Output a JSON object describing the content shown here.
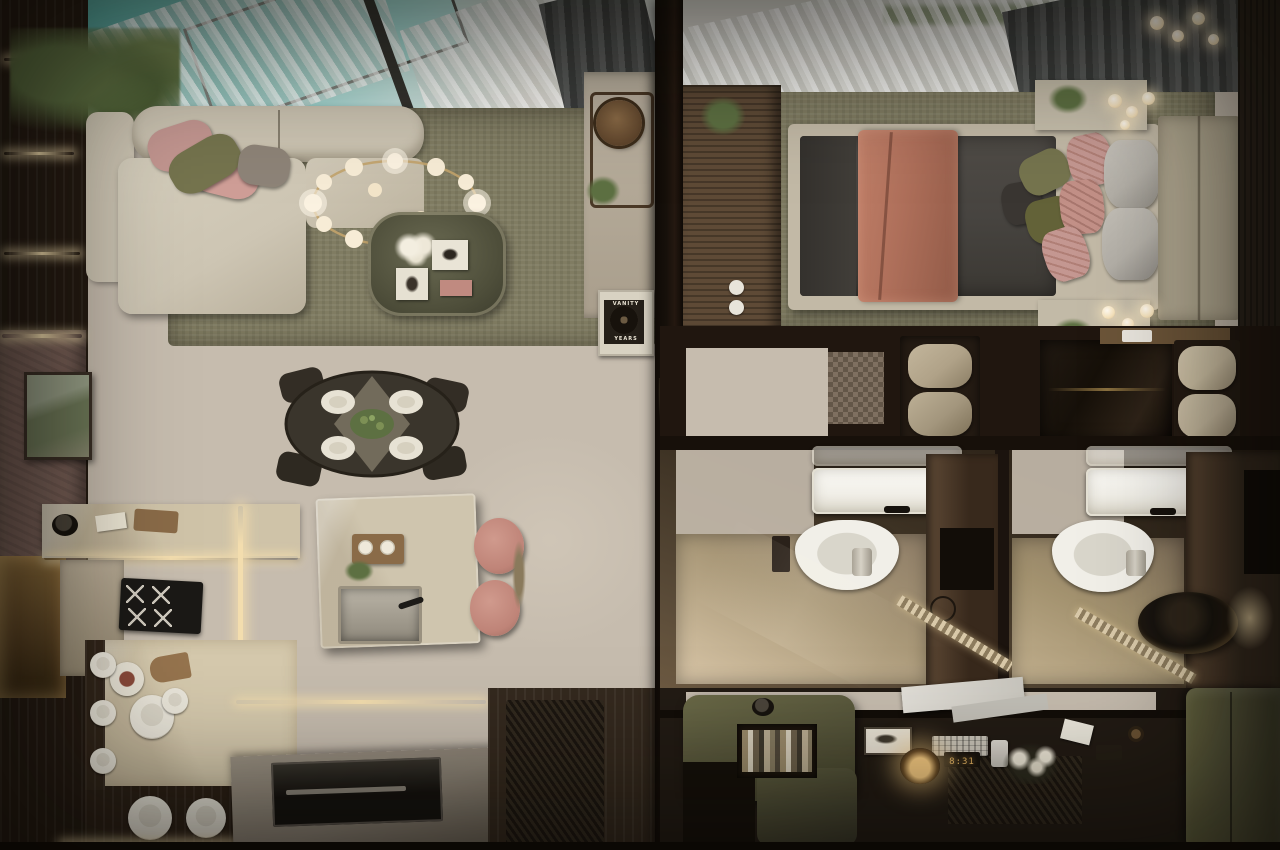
{
  "scene": {
    "view": "top-down interior render",
    "left_unit": "living room, dining, kitchen with island and pool-facing skylight window",
    "right_unit": "bedroom, entry benches, two bathrooms, home office with desk and olive sofas"
  },
  "texts": {
    "poster_line1": "VANITY",
    "poster_line2": "YEARS",
    "clock_display": "8:31"
  },
  "palette": {
    "wood-dark": "#241a12",
    "wood-console": "#5e4a36",
    "divider": "#16100a",
    "floor-terrazzo": "#c6bcae",
    "floor-speckle": "#92postfix",
    "floor-speckle2": "#928474",
    "rug-olive": "#807c62",
    "sofa-beige": "#cdc5b3",
    "pillow-pink": "#c49791",
    "pillow-olive": "#75744e",
    "pool-teal": "#8ecfc8",
    "pool-teal-deep": "#56aca4",
    "curtain-sheer": "#e8e7e3",
    "curtain-dark": "#4e504f",
    "brass": "#c2a36b",
    "glow-warm": "#f6e3bd",
    "led-glow": "#f3ddae",
    "table-dark": "#3a352c",
    "plate-white": "#eae6da",
    "island-marble": "#cfc5ae",
    "stool-pink": "#bf8478",
    "hob-black": "#1b1916",
    "cabinet-taupe": "#8d8477",
    "bed-duvet": "#474440",
    "bed-throw": "#ae6f5a",
    "bed-frame": "#c2b9a6",
    "headboard": "#afa68f",
    "pillow-gray": "#b2aea6",
    "wall-mauve": "#7b625a",
    "art-green": "#6f7a5a",
    "sink-white": "#f1efe8",
    "vanity-dark": "#38291c",
    "bench-leather": "#b0a288",
    "marble-black": "#161009",
    "office-floor": "#221b14",
    "desk-wood": "#a89a80",
    "sofa-olive": "#56553a",
    "lamp-glow": "#f3c880",
    "mat-dark": "#2b241b",
    "clock-glow": "#e8b765",
    "plant-green": "#5d7042"
  },
  "inventory": {
    "living": [
      "l-shaped-sofa",
      "ring-chandelier",
      "glass-coffee-table",
      "round-dining-table",
      "kitchen-island",
      "pink-stools",
      "gas-hob",
      "plate-shelves",
      "framed-artwork",
      "vanity-years-poster"
    ],
    "bedroom": [
      "double-bed",
      "terracotta-throw",
      "quilted-pillows",
      "headboard",
      "nightstand-pendant-lights",
      "media-console"
    ],
    "bathrooms": [
      "sink",
      "toilet",
      "vanity",
      "shower-drain",
      "rain-shower-head",
      "leather-bench"
    ],
    "office": [
      "desk",
      "laptop",
      "keyboard",
      "desk-lamp",
      "digital-clock",
      "phone",
      "bookshelf",
      "olive-sofa",
      "green-bench"
    ]
  }
}
